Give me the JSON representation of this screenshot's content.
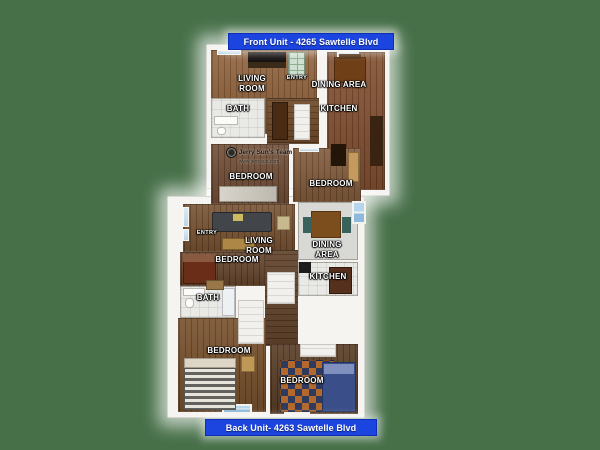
{
  "canvas": {
    "width": 600,
    "height": 450
  },
  "colors": {
    "background_green": "#477049",
    "banner_blue": "#1C45DF",
    "wall_white": "#F5F4F1",
    "window_blue": "#A9CFE8",
    "wood_brown": "#7B4C28"
  },
  "watermark": {
    "name": "Jerry Sun's Team",
    "website": "www.jerrysun.com"
  },
  "front_unit": {
    "banner_label": "Front Unit - 4265 Sawtelle Blvd",
    "labels": {
      "living_room": "LIVING ROOM",
      "entry": "ENTRY",
      "dining_area": "DINING AREA",
      "kitchen": "KITCHEN",
      "bath": "BATH",
      "bedroom_left": "BEDROOM",
      "bedroom_right": "BEDROOM"
    }
  },
  "back_unit": {
    "banner_label": "Back Unit- 4263 Sawtelle Blvd",
    "labels": {
      "entry": "ENTRY",
      "living_room": "LIVING ROOM",
      "bedroom_top": "BEDROOM",
      "dining_area": "DINING AREA",
      "kitchen": "KITCHEN",
      "bath": "BATH",
      "bedroom_bottom_left": "BEDROOM",
      "bedroom_bottom_right": "BEDROOM"
    }
  }
}
